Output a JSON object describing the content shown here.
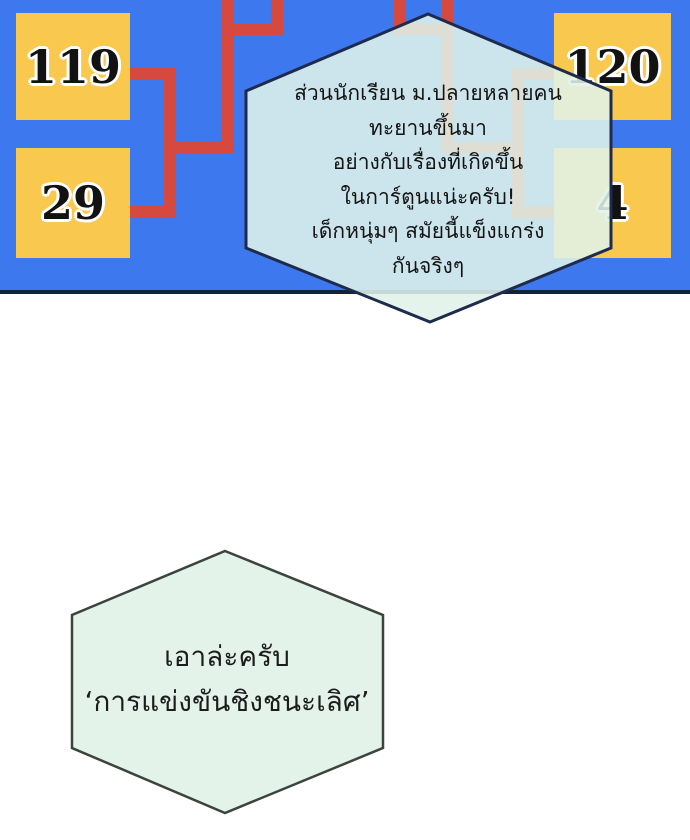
{
  "page": {
    "background": "#ffffff"
  },
  "panel": {
    "background": "#3e78ee",
    "border_color": "#15203c",
    "box_color": "#f9c84e",
    "bracket_color": "#d6493f",
    "boxes": [
      {
        "label": "119"
      },
      {
        "label": "29"
      },
      {
        "label": "120"
      },
      {
        "label": "4"
      }
    ]
  },
  "bubbles": {
    "top": {
      "fill": "rgba(224,242,234,0.88)",
      "stroke": "#1e2b4c",
      "lines": [
        "ส่วนนักเรียน ม.ปลายหลายคน",
        "ทะยานขึ้นมา",
        "อย่างกับเรื่องที่เกิดขึ้น",
        "ในการ์ตูนแน่ะครับ!",
        "เด็กหนุ่มๆ สมัยนี้แข็งแกร่ง",
        "กันจริงๆ"
      ]
    },
    "bottom": {
      "fill": "rgba(227,243,233,0.97)",
      "stroke": "#3c443e",
      "lines": [
        "เอาล่ะครับ",
        "‘การแข่งขันชิงชนะเลิศ’"
      ]
    }
  }
}
